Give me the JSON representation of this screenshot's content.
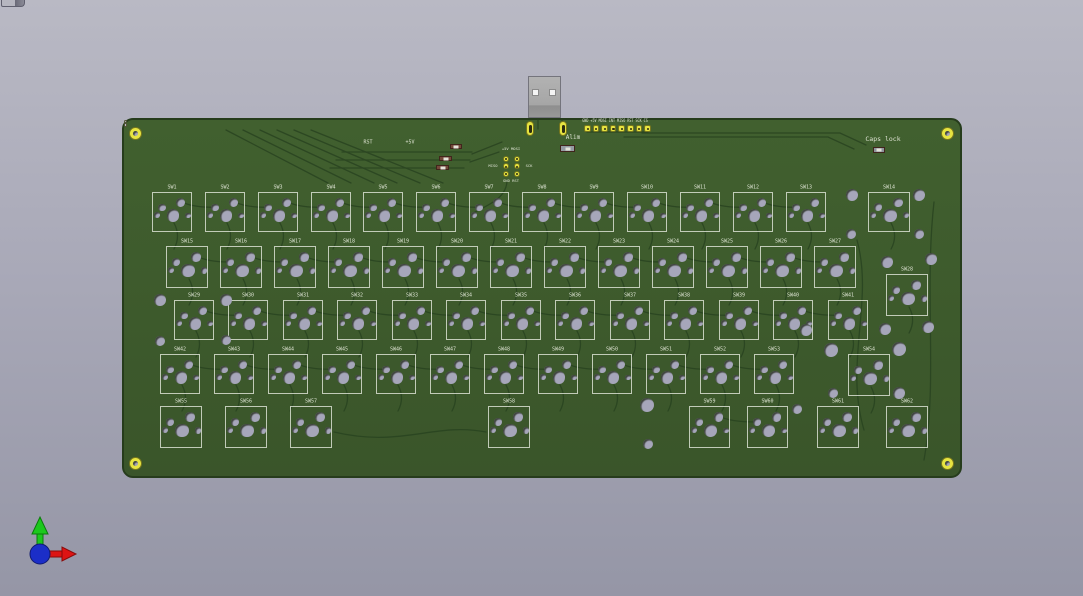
{
  "viewer": {
    "name": "pcb-3d-viewer"
  },
  "colors": {
    "background_top": "#b9b9c4",
    "background_bottom": "#9596a6",
    "board_green": "#3e5a2e",
    "board_edge": "#263c1c",
    "trace": "#2a4521",
    "silkscreen": "#dde3d2",
    "hole": "#a6a6ba",
    "pad_yellow": "#e6e441",
    "usb_metal": "#a8a8a8",
    "component_body": "#74493a",
    "axis_x_red": "#dd1414",
    "axis_y_green": "#1cc81c",
    "axis_origin_blue": "#1b2ec8"
  },
  "corner_icon": {
    "name": "window-corner-icon",
    "x": 1,
    "y": 0,
    "w": 22,
    "h": 6
  },
  "board": {
    "x": 122,
    "y": 118,
    "w": 840,
    "h": 360,
    "mounting_holes": [
      {
        "x": 133,
        "y": 131
      },
      {
        "x": 945,
        "y": 131
      },
      {
        "x": 133,
        "y": 461
      },
      {
        "x": 945,
        "y": 461
      }
    ]
  },
  "usb": {
    "x": 528,
    "y": 76,
    "w": 33,
    "h": 42,
    "holes": [
      {
        "x": 532,
        "y": 89
      },
      {
        "x": 549,
        "y": 89
      }
    ],
    "shield_pads": [
      {
        "x": 524,
        "y": 119
      },
      {
        "x": 557,
        "y": 119
      }
    ],
    "vias": [
      {
        "x": 541,
        "y": 126
      },
      {
        "x": 551,
        "y": 126
      }
    ]
  },
  "header8": {
    "labels": [
      "GND",
      "+5V",
      "MOSI",
      "INT",
      "MISO",
      "RST",
      "SCK",
      "CS"
    ],
    "x": 582,
    "y": 123,
    "pitch": 8.6,
    "size": 6.5,
    "label_cx": 613,
    "label_cy": 119
  },
  "isp_header": {
    "pads": [
      [
        503.7,
        156.7
      ],
      [
        514.7,
        156.7
      ],
      [
        503.7,
        164.3
      ],
      [
        514.7,
        164.3
      ],
      [
        503.7,
        172
      ],
      [
        514.7,
        172
      ]
    ],
    "labels": {
      "top": "+5V MOSI",
      "left": "MISO",
      "right": "SCK",
      "bottom": "GND RST"
    },
    "label_pos": {
      "top": [
        509,
        147
      ],
      "left": [
        491,
        164
      ],
      "right": [
        527,
        164
      ],
      "bottom": [
        509,
        179
      ]
    }
  },
  "silk_labels": [
    {
      "text": "RST",
      "x": 366,
      "y": 141,
      "size": 5
    },
    {
      "text": "+5V",
      "x": 408,
      "y": 141,
      "size": 5
    },
    {
      "text": "Alim",
      "x": 571,
      "y": 136,
      "size": 6
    },
    {
      "text": "Caps lock",
      "x": 881,
      "y": 137,
      "size": 6.5
    }
  ],
  "components": [
    {
      "name": "alim-component",
      "x": 558,
      "y": 143,
      "w": 15,
      "h": 7,
      "body": "#959ba3"
    },
    {
      "name": "capslock-led",
      "x": 871,
      "y": 145,
      "w": 12,
      "h": 6,
      "body": "#8e949c"
    },
    {
      "name": "smd-component-1",
      "x": 448,
      "y": 142,
      "w": 12,
      "h": 5,
      "body": "#74493a"
    },
    {
      "name": "smd-component-2",
      "x": 437,
      "y": 154,
      "w": 13,
      "h": 5,
      "body": "#74493a"
    },
    {
      "name": "smd-component-3",
      "x": 434,
      "y": 163,
      "w": 13,
      "h": 5,
      "body": "#74493a"
    }
  ],
  "switch_hole_pattern": [
    {
      "fx": 0.5,
      "fy": 0.56,
      "fr": 0.16
    },
    {
      "fx": 0.69,
      "fy": 0.24,
      "fr": 0.115
    },
    {
      "fx": 0.22,
      "fy": 0.36,
      "fr": 0.095
    },
    {
      "fx": 0.1,
      "fy": 0.55,
      "fr": 0.072
    },
    {
      "fx": 0.88,
      "fy": 0.56,
      "fr": 0.072
    }
  ],
  "switches": [
    {
      "l": "SW1",
      "x": 150,
      "y": 190,
      "w": 40,
      "h": 40
    },
    {
      "l": "SW2",
      "x": 203,
      "y": 190,
      "w": 40,
      "h": 40
    },
    {
      "l": "SW3",
      "x": 256,
      "y": 190,
      "w": 40,
      "h": 40
    },
    {
      "l": "SW4",
      "x": 309,
      "y": 190,
      "w": 40,
      "h": 40
    },
    {
      "l": "SW5",
      "x": 361,
      "y": 190,
      "w": 40,
      "h": 40
    },
    {
      "l": "SW6",
      "x": 414,
      "y": 190,
      "w": 40,
      "h": 40
    },
    {
      "l": "SW7",
      "x": 467,
      "y": 190,
      "w": 40,
      "h": 40
    },
    {
      "l": "SW8",
      "x": 520,
      "y": 190,
      "w": 40,
      "h": 40
    },
    {
      "l": "SW9",
      "x": 572,
      "y": 190,
      "w": 40,
      "h": 40
    },
    {
      "l": "SW10",
      "x": 625,
      "y": 190,
      "w": 40,
      "h": 40
    },
    {
      "l": "SW11",
      "x": 678,
      "y": 190,
      "w": 40,
      "h": 40
    },
    {
      "l": "SW12",
      "x": 731,
      "y": 190,
      "w": 40,
      "h": 40
    },
    {
      "l": "SW13",
      "x": 784,
      "y": 190,
      "w": 40,
      "h": 40
    },
    {
      "l": "SW14",
      "x": 866,
      "y": 190,
      "w": 42,
      "h": 40
    },
    {
      "l": "SW15",
      "x": 164,
      "y": 244,
      "w": 42,
      "h": 42
    },
    {
      "l": "SW16",
      "x": 218,
      "y": 244,
      "w": 42,
      "h": 42
    },
    {
      "l": "SW17",
      "x": 272,
      "y": 244,
      "w": 42,
      "h": 42
    },
    {
      "l": "SW18",
      "x": 326,
      "y": 244,
      "w": 42,
      "h": 42
    },
    {
      "l": "SW19",
      "x": 380,
      "y": 244,
      "w": 42,
      "h": 42
    },
    {
      "l": "SW20",
      "x": 434,
      "y": 244,
      "w": 42,
      "h": 42
    },
    {
      "l": "SW21",
      "x": 488,
      "y": 244,
      "w": 42,
      "h": 42
    },
    {
      "l": "SW22",
      "x": 542,
      "y": 244,
      "w": 42,
      "h": 42
    },
    {
      "l": "SW23",
      "x": 596,
      "y": 244,
      "w": 42,
      "h": 42
    },
    {
      "l": "SW24",
      "x": 650,
      "y": 244,
      "w": 42,
      "h": 42
    },
    {
      "l": "SW25",
      "x": 704,
      "y": 244,
      "w": 42,
      "h": 42
    },
    {
      "l": "SW26",
      "x": 758,
      "y": 244,
      "w": 42,
      "h": 42
    },
    {
      "l": "SW27",
      "x": 812,
      "y": 244,
      "w": 42,
      "h": 42
    },
    {
      "l": "SW28",
      "x": 884,
      "y": 272,
      "w": 42,
      "h": 42
    },
    {
      "l": "SW29",
      "x": 172,
      "y": 298,
      "w": 40,
      "h": 40
    },
    {
      "l": "SW30",
      "x": 226,
      "y": 298,
      "w": 40,
      "h": 40
    },
    {
      "l": "SW31",
      "x": 281,
      "y": 298,
      "w": 40,
      "h": 40
    },
    {
      "l": "SW32",
      "x": 335,
      "y": 298,
      "w": 40,
      "h": 40
    },
    {
      "l": "SW33",
      "x": 390,
      "y": 298,
      "w": 40,
      "h": 40
    },
    {
      "l": "SW34",
      "x": 444,
      "y": 298,
      "w": 40,
      "h": 40
    },
    {
      "l": "SW35",
      "x": 499,
      "y": 298,
      "w": 40,
      "h": 40
    },
    {
      "l": "SW36",
      "x": 553,
      "y": 298,
      "w": 40,
      "h": 40
    },
    {
      "l": "SW37",
      "x": 608,
      "y": 298,
      "w": 40,
      "h": 40
    },
    {
      "l": "SW38",
      "x": 662,
      "y": 298,
      "w": 40,
      "h": 40
    },
    {
      "l": "SW39",
      "x": 717,
      "y": 298,
      "w": 40,
      "h": 40
    },
    {
      "l": "SW40",
      "x": 771,
      "y": 298,
      "w": 40,
      "h": 40
    },
    {
      "l": "SW41",
      "x": 826,
      "y": 298,
      "w": 40,
      "h": 40
    },
    {
      "l": "SW42",
      "x": 158,
      "y": 352,
      "w": 40,
      "h": 40
    },
    {
      "l": "SW43",
      "x": 212,
      "y": 352,
      "w": 40,
      "h": 40
    },
    {
      "l": "SW44",
      "x": 266,
      "y": 352,
      "w": 40,
      "h": 40
    },
    {
      "l": "SW45",
      "x": 320,
      "y": 352,
      "w": 40,
      "h": 40
    },
    {
      "l": "SW46",
      "x": 374,
      "y": 352,
      "w": 40,
      "h": 40
    },
    {
      "l": "SW47",
      "x": 428,
      "y": 352,
      "w": 40,
      "h": 40
    },
    {
      "l": "SW48",
      "x": 482,
      "y": 352,
      "w": 40,
      "h": 40
    },
    {
      "l": "SW49",
      "x": 536,
      "y": 352,
      "w": 40,
      "h": 40
    },
    {
      "l": "SW50",
      "x": 590,
      "y": 352,
      "w": 40,
      "h": 40
    },
    {
      "l": "SW51",
      "x": 644,
      "y": 352,
      "w": 40,
      "h": 40
    },
    {
      "l": "SW52",
      "x": 698,
      "y": 352,
      "w": 40,
      "h": 40
    },
    {
      "l": "SW53",
      "x": 752,
      "y": 352,
      "w": 40,
      "h": 40
    },
    {
      "l": "SW54",
      "x": 846,
      "y": 352,
      "w": 42,
      "h": 42
    },
    {
      "l": "SW55",
      "x": 158,
      "y": 404,
      "w": 42,
      "h": 42
    },
    {
      "l": "SW56",
      "x": 223,
      "y": 404,
      "w": 42,
      "h": 42
    },
    {
      "l": "SW57",
      "x": 288,
      "y": 404,
      "w": 42,
      "h": 42
    },
    {
      "l": "SW58",
      "x": 486,
      "y": 404,
      "w": 42,
      "h": 42
    },
    {
      "l": "SW59",
      "x": 687,
      "y": 404,
      "w": 41,
      "h": 42
    },
    {
      "l": "SW60",
      "x": 745,
      "y": 404,
      "w": 41,
      "h": 42
    },
    {
      "l": "SW61",
      "x": 815,
      "y": 404,
      "w": 42,
      "h": 42
    },
    {
      "l": "SW62",
      "x": 884,
      "y": 404,
      "w": 42,
      "h": 42
    }
  ],
  "free_holes": [
    {
      "x": 850,
      "y": 193,
      "r": 6
    },
    {
      "x": 917,
      "y": 193,
      "r": 6
    },
    {
      "x": 849,
      "y": 232,
      "r": 5
    },
    {
      "x": 917,
      "y": 232,
      "r": 5
    },
    {
      "x": 885,
      "y": 260,
      "r": 6
    },
    {
      "x": 929,
      "y": 257,
      "r": 6
    },
    {
      "x": 883,
      "y": 327,
      "r": 6
    },
    {
      "x": 926,
      "y": 325,
      "r": 6
    },
    {
      "x": 804,
      "y": 328,
      "r": 6
    },
    {
      "x": 158,
      "y": 298,
      "r": 6
    },
    {
      "x": 224,
      "y": 298,
      "r": 6
    },
    {
      "x": 158,
      "y": 339,
      "r": 5
    },
    {
      "x": 224,
      "y": 338,
      "r": 5
    },
    {
      "x": 829,
      "y": 348,
      "r": 7
    },
    {
      "x": 897,
      "y": 347,
      "r": 7
    },
    {
      "x": 831,
      "y": 391,
      "r": 5
    },
    {
      "x": 897,
      "y": 391,
      "r": 6
    },
    {
      "x": 645,
      "y": 403,
      "r": 7
    },
    {
      "x": 646,
      "y": 442,
      "r": 5
    },
    {
      "x": 795,
      "y": 407,
      "r": 5
    }
  ],
  "gizmo": {
    "x": 24,
    "y": 512,
    "w": 70,
    "h": 64
  }
}
